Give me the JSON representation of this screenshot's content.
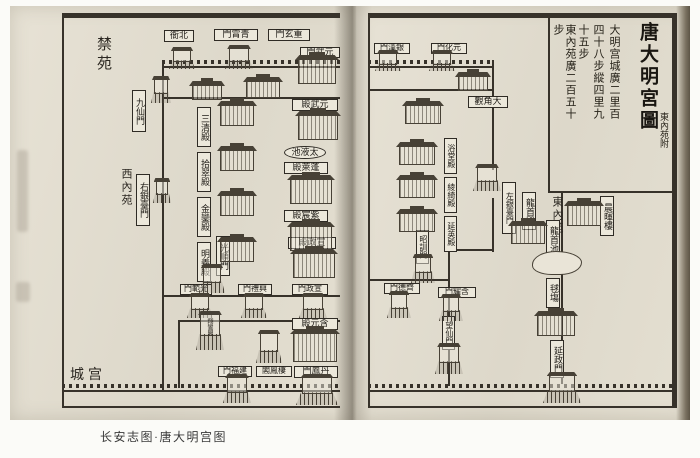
{
  "caption": "长安志图·唐大明宫图",
  "colors": {
    "paper": "#e4dfd2",
    "ink": "#37322a"
  },
  "right_page": {
    "title_block": {
      "title": "唐大明宮圖",
      "subtitle": "東內苑附",
      "note_columns": [
        "大明宫城廣二里百",
        "四十八步縱四里九",
        "十五步",
        "東內苑廣二百五十",
        "步"
      ]
    },
    "labels": {
      "yinhan_men": "銀漢門",
      "yuanhua_men": "元化門",
      "dajiao_guan": "大角觀",
      "yutang_dian": "浴堂殿",
      "lingqi_dian": "綾綺殿",
      "yanying_dian": "延英殿",
      "zhaoxun_men": "昭訓門",
      "qide_men": "齊德門",
      "hanyao_men": "含耀門",
      "wangxian_men": "望仙門",
      "zuoyintai_men": "左銀臺門",
      "dongneiyuan": "東內苑",
      "longshou_dian": "龍首殿",
      "longshou_chi": "龍首池",
      "chenhui_lou": "晨暉樓",
      "qiuchang": "毬塲",
      "yanzheng_men": "延政門"
    }
  },
  "left_page": {
    "labels": {
      "jinyuan": "禁苑",
      "beiya": "北衙",
      "qingxiao_men": "青霄門",
      "chongxuan_men": "重玄門",
      "yuanwu_men": "元武門",
      "jiuxian_men": "九仙門",
      "sanqing_dian": "三清殿",
      "shicui_dian": "拾翠殿",
      "jinluan_dian": "金鑾殿",
      "mingyi_dian": "明義殿",
      "xineiyuan": "西內苑",
      "youyintai_men": "右銀臺門",
      "yuanwu_dian": "元武殿",
      "taiye_chi": "太液池",
      "penglai_dian": "蓬萊殿",
      "zichen_dian": "紫宸殿",
      "xuanzheng_dian": "宣政殿",
      "guangshun_men": "光順門",
      "guangfan_men": "光範門",
      "xingli_men": "興禮門",
      "xuanzheng_men": "宣政門",
      "hanyuan_dian": "含元殿",
      "xiangluan_ge": "翔鸞閣",
      "qifeng_ge": "棲鳳閣",
      "jianfu_men": "建福門",
      "danfeng_men": "丹鳳門",
      "gongcheng": "宫城"
    }
  }
}
